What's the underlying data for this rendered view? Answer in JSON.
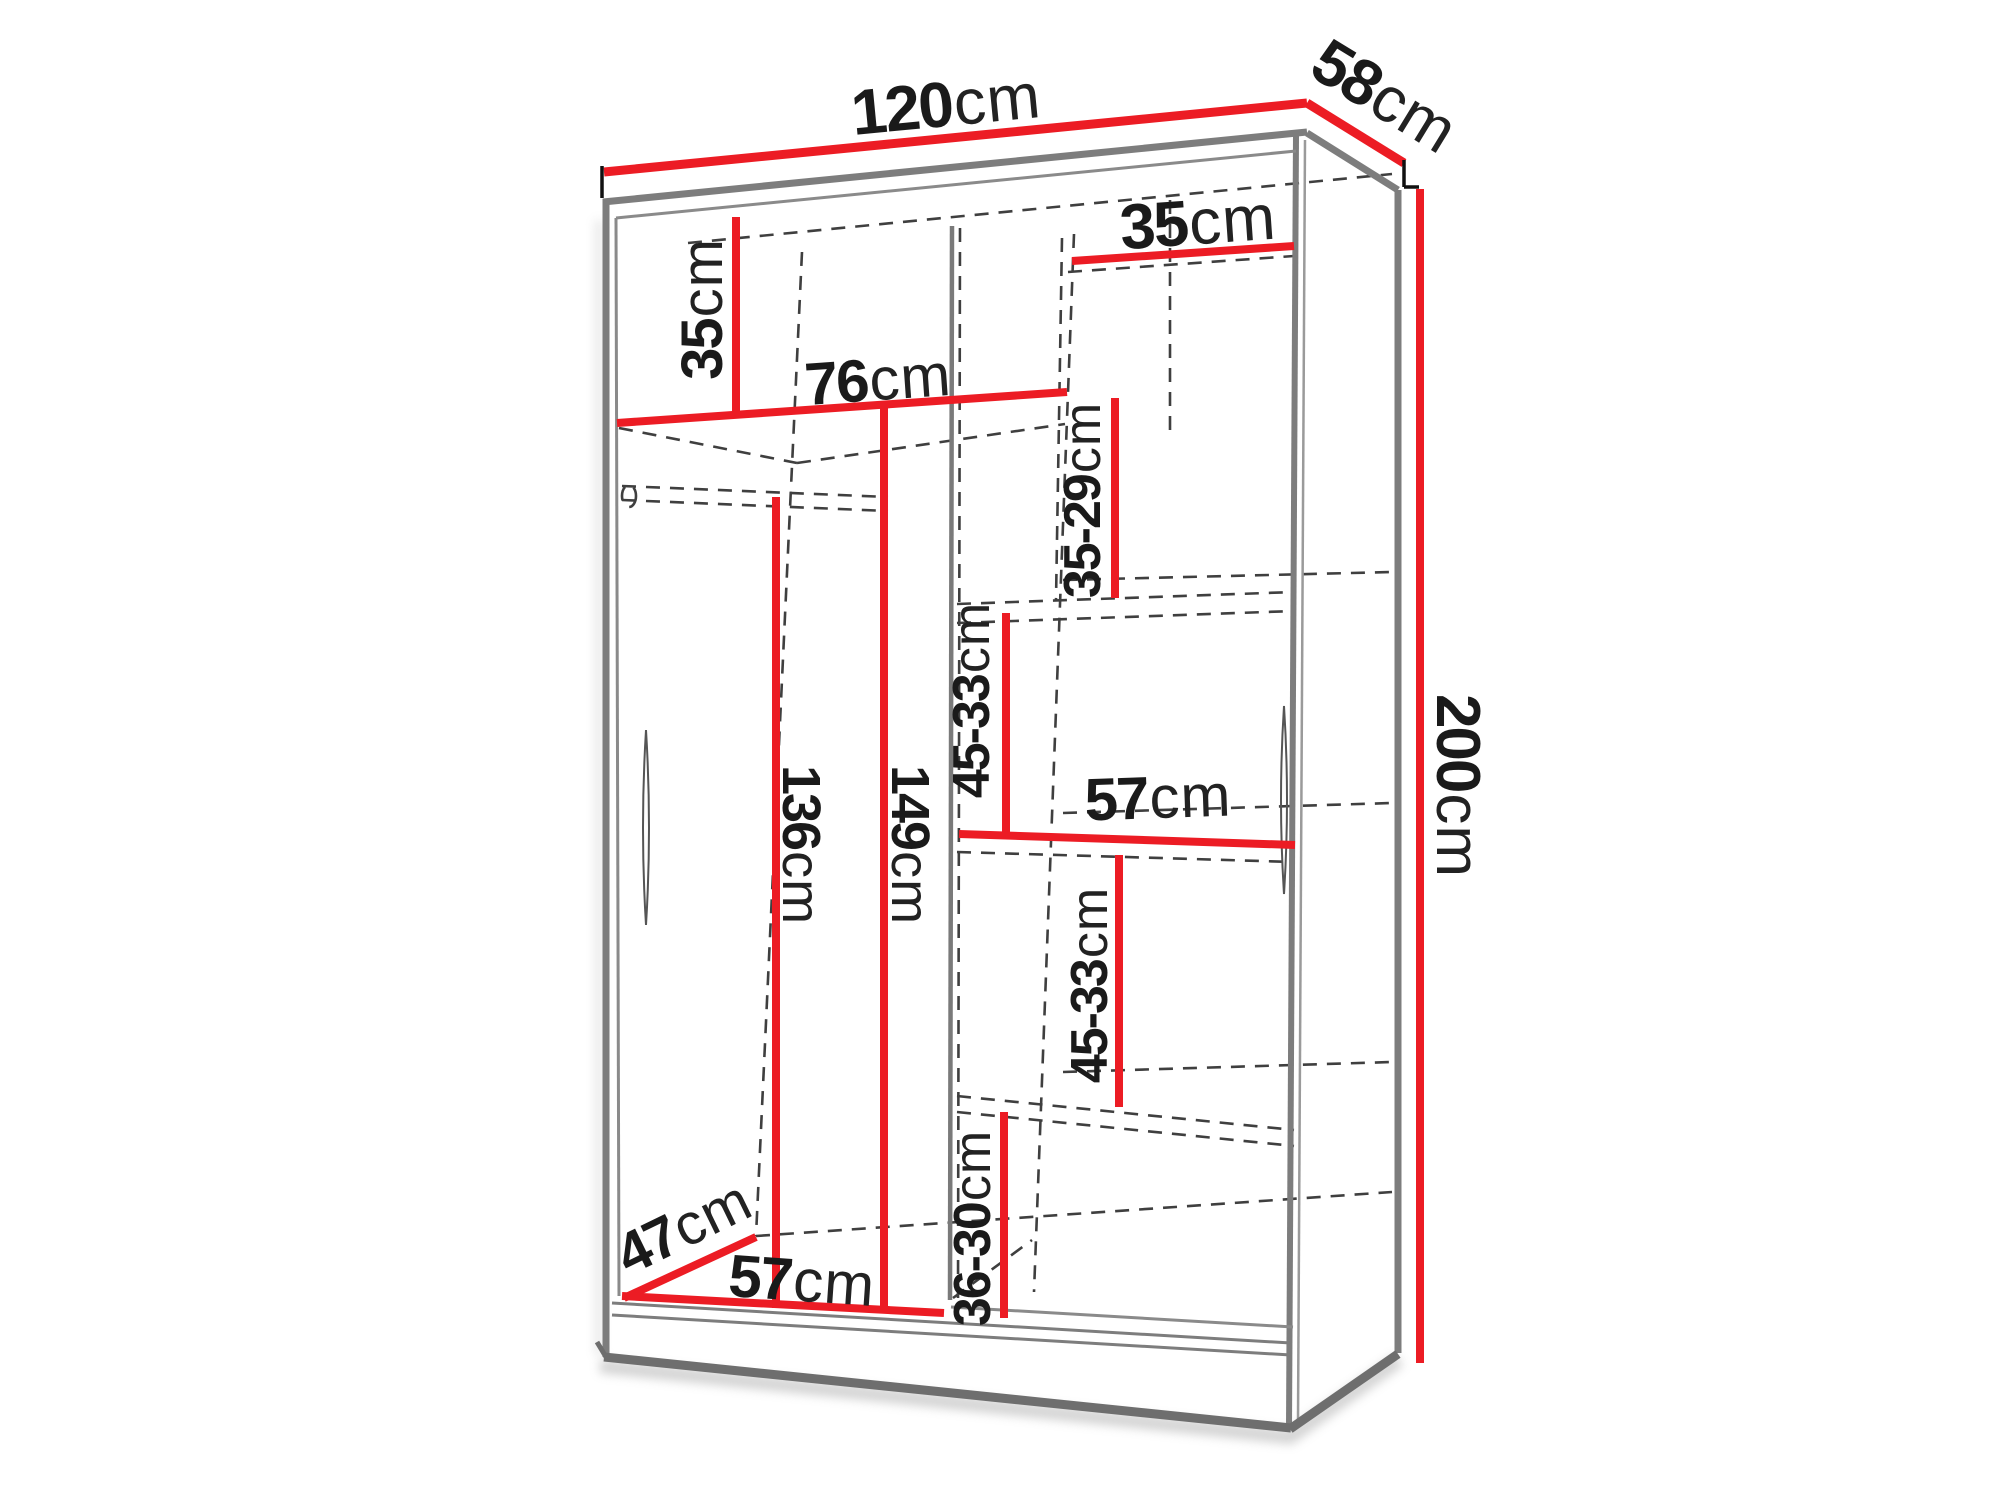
{
  "diagram": {
    "type": "furniture-dimension-diagram",
    "subject": "sliding-door wardrobe with interior shelf and hanging-rail dimensions",
    "unit": "cm"
  },
  "colors": {
    "dimension_line": "#ec1c24",
    "outline": "#7d7d7d",
    "text": "#1a1a1a",
    "background": "#ffffff"
  },
  "dimensions": [
    {
      "id": "overall-width",
      "value": "120",
      "unit": "cm"
    },
    {
      "id": "overall-depth",
      "value": "58",
      "unit": "cm"
    },
    {
      "id": "overall-height",
      "value": "200",
      "unit": "cm"
    },
    {
      "id": "top-left-compartment-height",
      "value": "35",
      "unit": "cm"
    },
    {
      "id": "left-section-width",
      "value": "76",
      "unit": "cm"
    },
    {
      "id": "top-right-shelf-width",
      "value": "35",
      "unit": "cm"
    },
    {
      "id": "right-shelf-gap-upper",
      "value": "35-29",
      "unit": "cm"
    },
    {
      "id": "right-shelf-gap-middle",
      "value": "45-33",
      "unit": "cm"
    },
    {
      "id": "middle-shelf-width",
      "value": "57",
      "unit": "cm"
    },
    {
      "id": "right-shelf-gap-lower",
      "value": "45-33",
      "unit": "cm"
    },
    {
      "id": "hanging-space-height",
      "value": "136",
      "unit": "cm"
    },
    {
      "id": "left-section-height",
      "value": "149",
      "unit": "cm"
    },
    {
      "id": "bottom-shelf-gap",
      "value": "36-30",
      "unit": "cm"
    },
    {
      "id": "interior-depth",
      "value": "47",
      "unit": "cm"
    },
    {
      "id": "bottom-section-width",
      "value": "57",
      "unit": "cm"
    }
  ]
}
